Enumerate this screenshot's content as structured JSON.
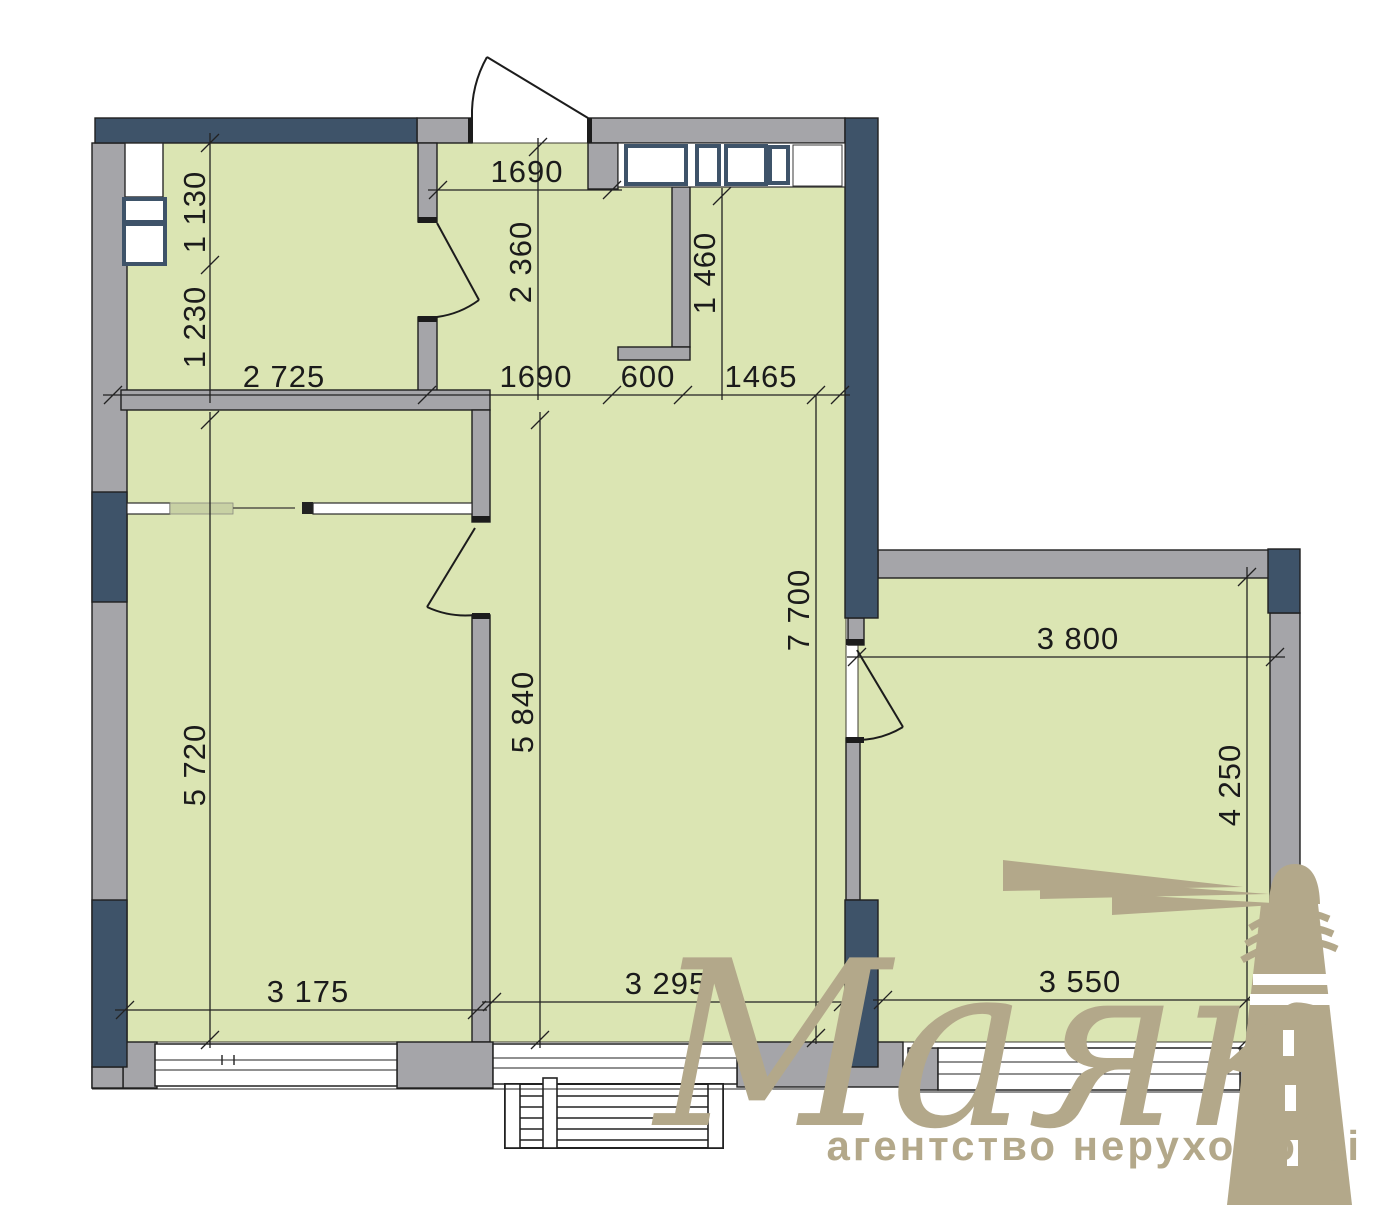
{
  "watermark": {
    "brand": "Маяк",
    "tagline": "агентство нерухомості"
  },
  "colors": {
    "room_fill": "#dbe5b3",
    "wall_gray": "#a5a5a9",
    "wall_navy": "#3e5369",
    "outline": "#1f1f1f",
    "dimension_text": "#1b1b1b",
    "watermark_tan": "#b3a88a"
  },
  "dimensions": {
    "hall_top_width": "1690",
    "hall_depth": "2 360",
    "niche_depth": "1 460",
    "closet_shaft_height": "1 130",
    "closet_height": "1 230",
    "closet_width": "2 725",
    "hall_width": "1690",
    "niche_width": "600",
    "hall_right_width": "1465",
    "bedroom_height": "5 720",
    "living_height": "5 840",
    "living_full_height": "7 700",
    "bedroom_width": "3 175",
    "living_width": "3 295",
    "kitchen_top_width": "3 800",
    "kitchen_height": "4 250",
    "kitchen_bottom_width": "3 550"
  }
}
